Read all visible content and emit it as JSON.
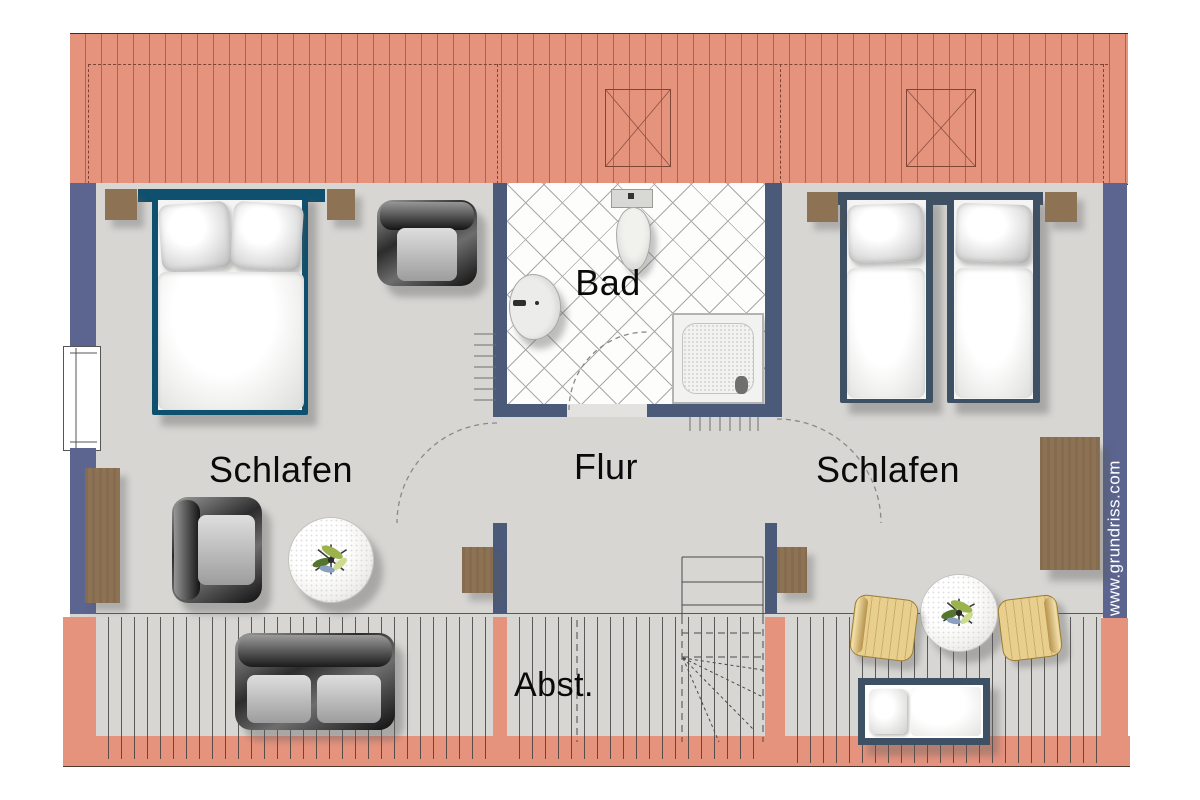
{
  "plan": {
    "rooms": [
      {
        "name": "bedroom-left",
        "label": "Schlafen"
      },
      {
        "name": "bathroom",
        "label": "Bad"
      },
      {
        "name": "hallway",
        "label": "Flur"
      },
      {
        "name": "bedroom-right",
        "label": "Schlafen"
      },
      {
        "name": "storage",
        "label": "Abst."
      }
    ],
    "watermark": "www.grundriss.com"
  },
  "colors": {
    "roof": "#e6937e",
    "wall": "#5b6590",
    "bath_wall": "#4b5a78",
    "floor": "#d7d6d3",
    "tile_line": "#a8a8a8",
    "bed_teal": "#0e506e",
    "bed_slate": "#3e5063",
    "wood": "#8d7254",
    "chair_yellow": "#e9cf8d",
    "table_white": "#f2f1ef",
    "label": "#0a0a0a",
    "watermark": "#ffffff"
  }
}
